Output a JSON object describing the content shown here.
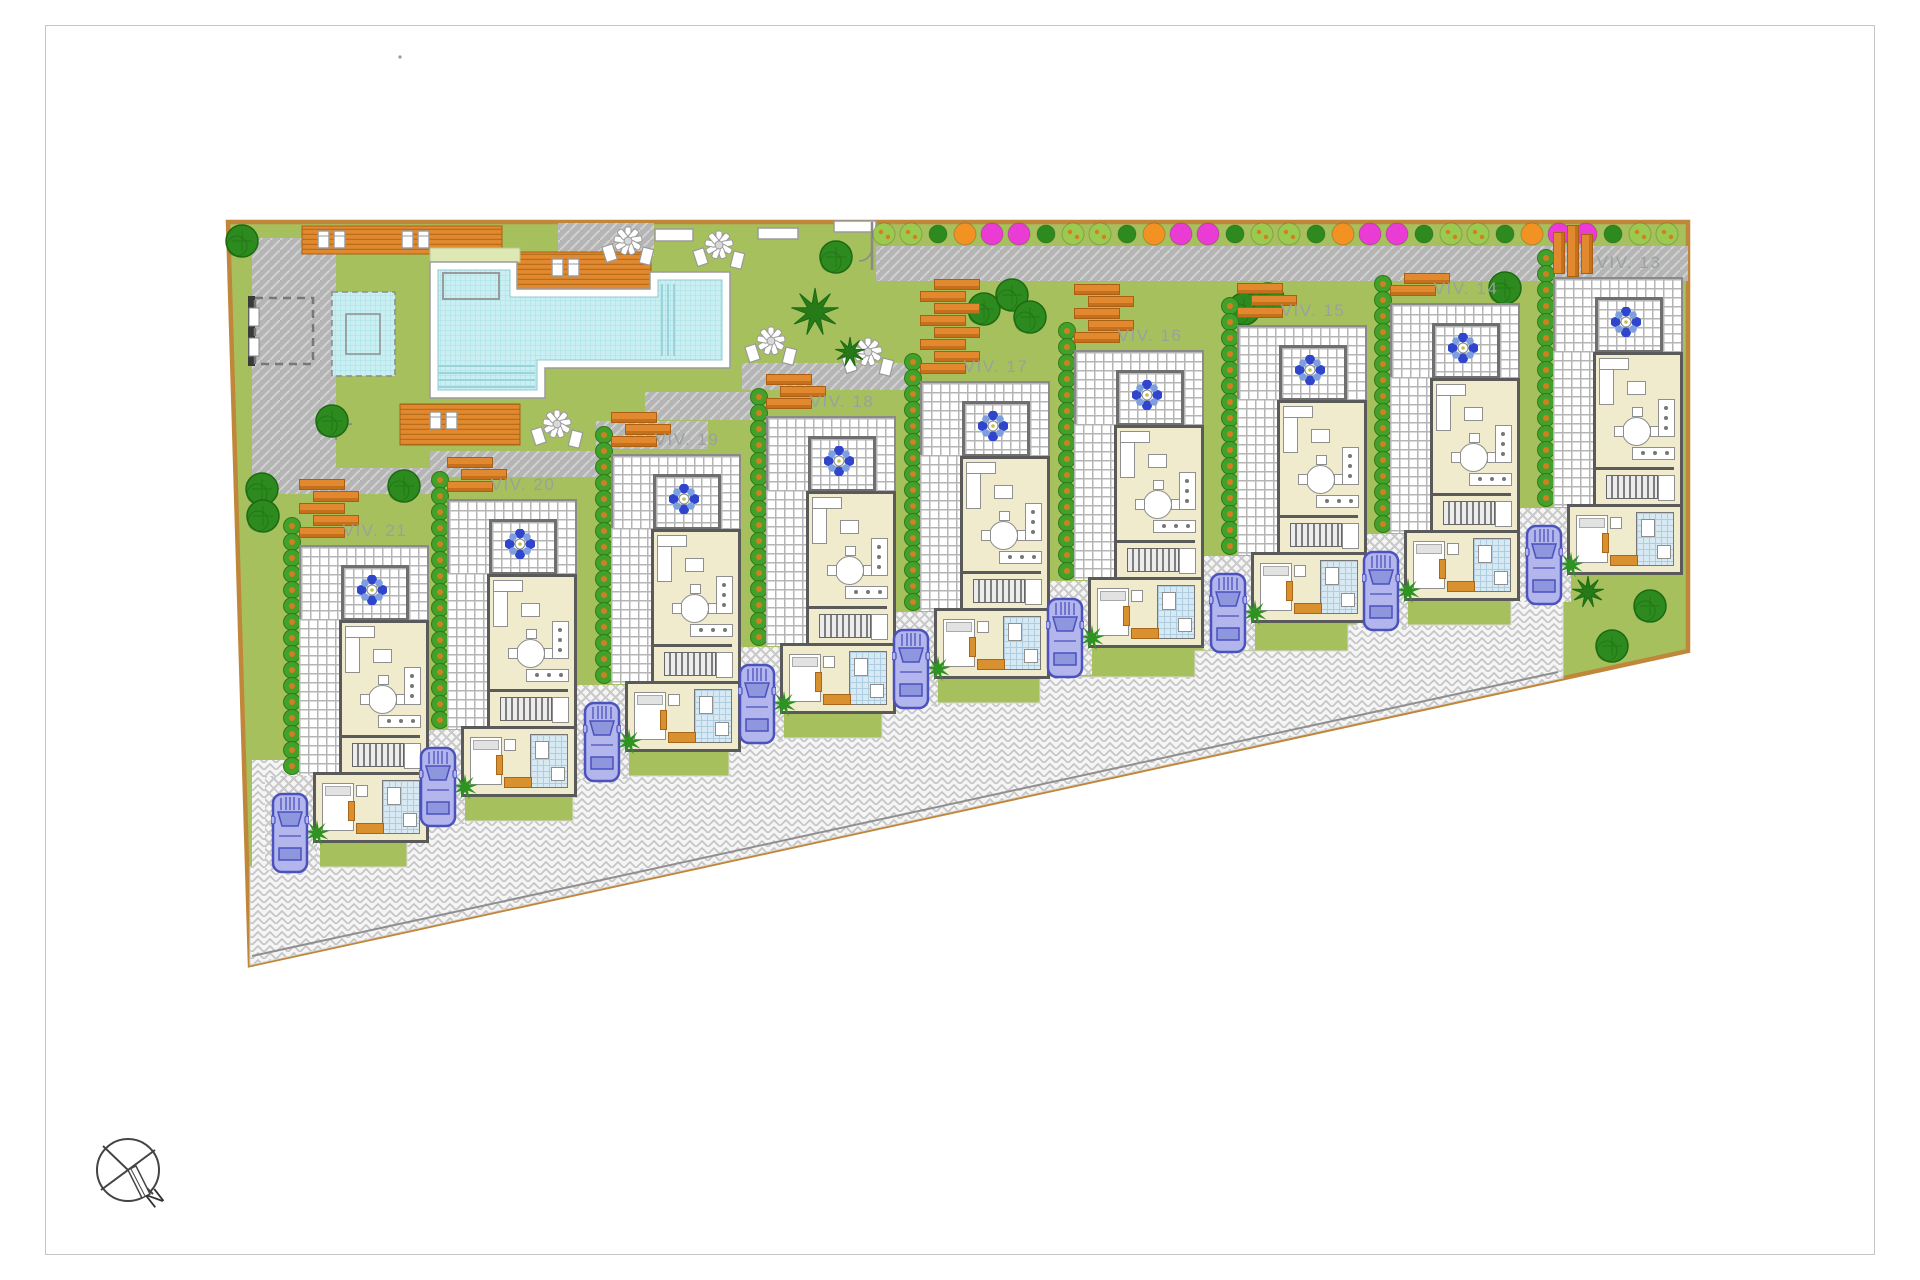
{
  "document": {
    "type": "residential development site plan",
    "units_shown": 9
  },
  "villas": [
    {
      "label": "VIV. 13",
      "x": 1545,
      "y": 277,
      "planks": 3,
      "pergola_style": "vertical"
    },
    {
      "label": "VIV. 14",
      "x": 1382,
      "y": 303,
      "planks": 2,
      "pergola_style": "stack"
    },
    {
      "label": "VIV. 15",
      "x": 1229,
      "y": 325,
      "planks": 3,
      "pergola_style": "stack"
    },
    {
      "label": "VIV. 16",
      "x": 1066,
      "y": 350,
      "planks": 5,
      "pergola_style": "stack"
    },
    {
      "label": "VIV. 17",
      "x": 912,
      "y": 381,
      "planks": 8,
      "pergola_style": "stack"
    },
    {
      "label": "VIV. 18",
      "x": 758,
      "y": 416,
      "planks": 3,
      "pergola_style": "stack"
    },
    {
      "label": "VIV. 19",
      "x": 603,
      "y": 454,
      "planks": 3,
      "pergola_style": "stack"
    },
    {
      "label": "VIV. 20",
      "x": 439,
      "y": 499,
      "planks": 3,
      "pergola_style": "stack"
    },
    {
      "label": "VIV. 21",
      "x": 291,
      "y": 545,
      "planks": 5,
      "pergola_style": "stack"
    }
  ],
  "compass": {
    "label": "N"
  },
  "colors": {
    "lawn": "#a7c05e",
    "boundary": "#c0873a",
    "path_gray": "#b5b5b5",
    "pool_water": "#c9eff3",
    "deck_orange": "#e2892f",
    "hedge_green": "#43a02a",
    "hedge_dot": "#d08020",
    "car_body": "#b2b6ec",
    "car_outline": "#4b51bd",
    "house_floor": "#f0ebcd",
    "house_wall": "#5a5a5a",
    "label_gray": "#9aa0a0",
    "flower_blue": "#2f46cc",
    "flower_magenta": "#ea3bd4",
    "bush_light": "#9cc94f",
    "bush_orange": "#f29222",
    "tree_green": "#2c8a1e",
    "bath_blue": "#d7e9f2"
  },
  "scenery": {
    "trees": [
      [
        242,
        241
      ],
      [
        332,
        421
      ],
      [
        404,
        486
      ],
      [
        836,
        257
      ],
      [
        984,
        309
      ],
      [
        1012,
        295
      ],
      [
        1030,
        317
      ],
      [
        1244,
        309
      ],
      [
        1268,
        299
      ],
      [
        1505,
        288
      ],
      [
        262,
        489
      ],
      [
        263,
        516
      ],
      [
        1650,
        606
      ],
      [
        1612,
        646
      ]
    ],
    "palms": [
      [
        815,
        312,
        24
      ],
      [
        850,
        352,
        15
      ],
      [
        1588,
        592,
        16
      ]
    ],
    "umbrellas": [
      [
        628,
        241
      ],
      [
        719,
        245
      ],
      [
        771,
        341
      ],
      [
        557,
        424
      ],
      [
        868,
        352
      ]
    ],
    "flower_row": {
      "x_start": 884,
      "x_end": 1676,
      "y": 234,
      "step": 27,
      "pattern": [
        "lg",
        "lg",
        "dg",
        "or",
        "mg",
        "mg",
        "dg"
      ]
    }
  }
}
